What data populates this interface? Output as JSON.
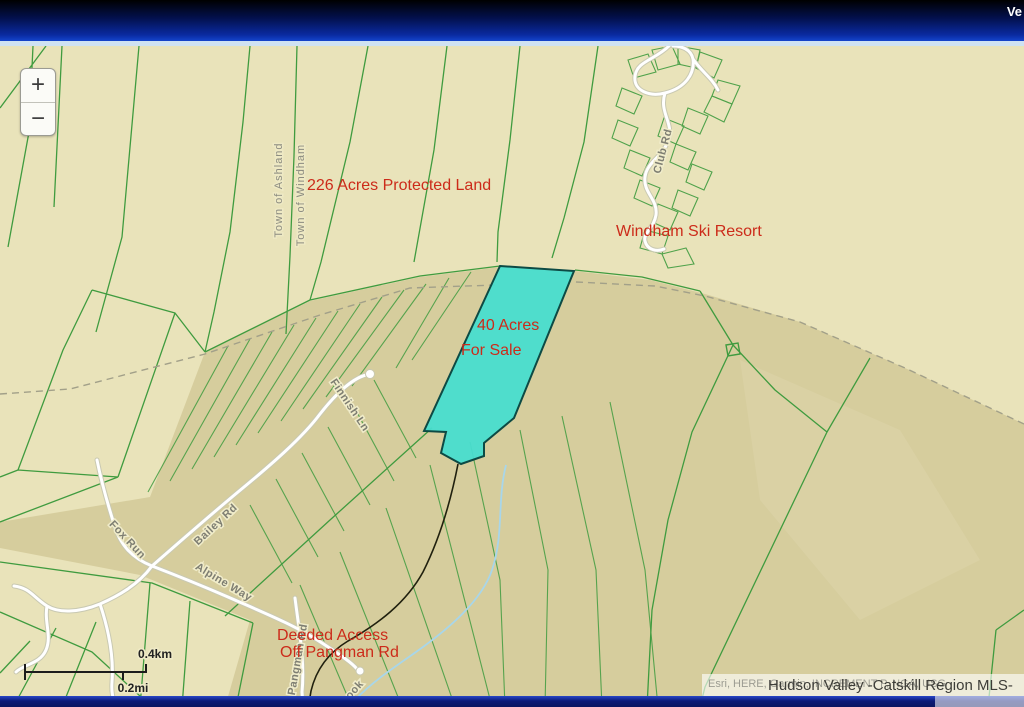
{
  "header": {
    "right_text": "Ve"
  },
  "map": {
    "controls": {
      "zoom_in": "+",
      "zoom_out": "−"
    },
    "labels": {
      "protected_land": "226 Acres Protected Land",
      "ski_resort": "Windham Ski Resort",
      "parcel_line1": "40 Acres",
      "parcel_line2": "For Sale",
      "access_line1": "Deeded Access",
      "access_line2": "Off Pangman Rd",
      "town_left": "Town of Ashland",
      "town_right": "Town of Windham"
    },
    "roads": {
      "fox_run": "Fox Run",
      "bailey": "Bailey Rd",
      "alpine": "Alpine Way",
      "finnish": "Finnish Ln",
      "club": "Club Rd",
      "pangman": "Pangman Rd",
      "stream": "ook"
    },
    "scale": {
      "km": "0.4km",
      "mi": "0.2mi"
    },
    "attribution": {
      "sources": "Esri, HERE, Garmin, INCREMENT P, NGA, USG",
      "mls": "Hudson Valley -Catskill Region MLS-"
    },
    "colors": {
      "header_top": "#000000",
      "header_bottom": "#1444cc",
      "map_base": "#e9e3ba",
      "terrain_shade": "#d6cd9d",
      "parcel_line_green": "#3f9b3f",
      "parcel_fill": "#48ddcf",
      "parcel_stroke": "#0d4a44",
      "label_red": "#cc2b1a",
      "road_label_gray": "#7e7e72",
      "footer_blue": "#0a1560"
    }
  }
}
